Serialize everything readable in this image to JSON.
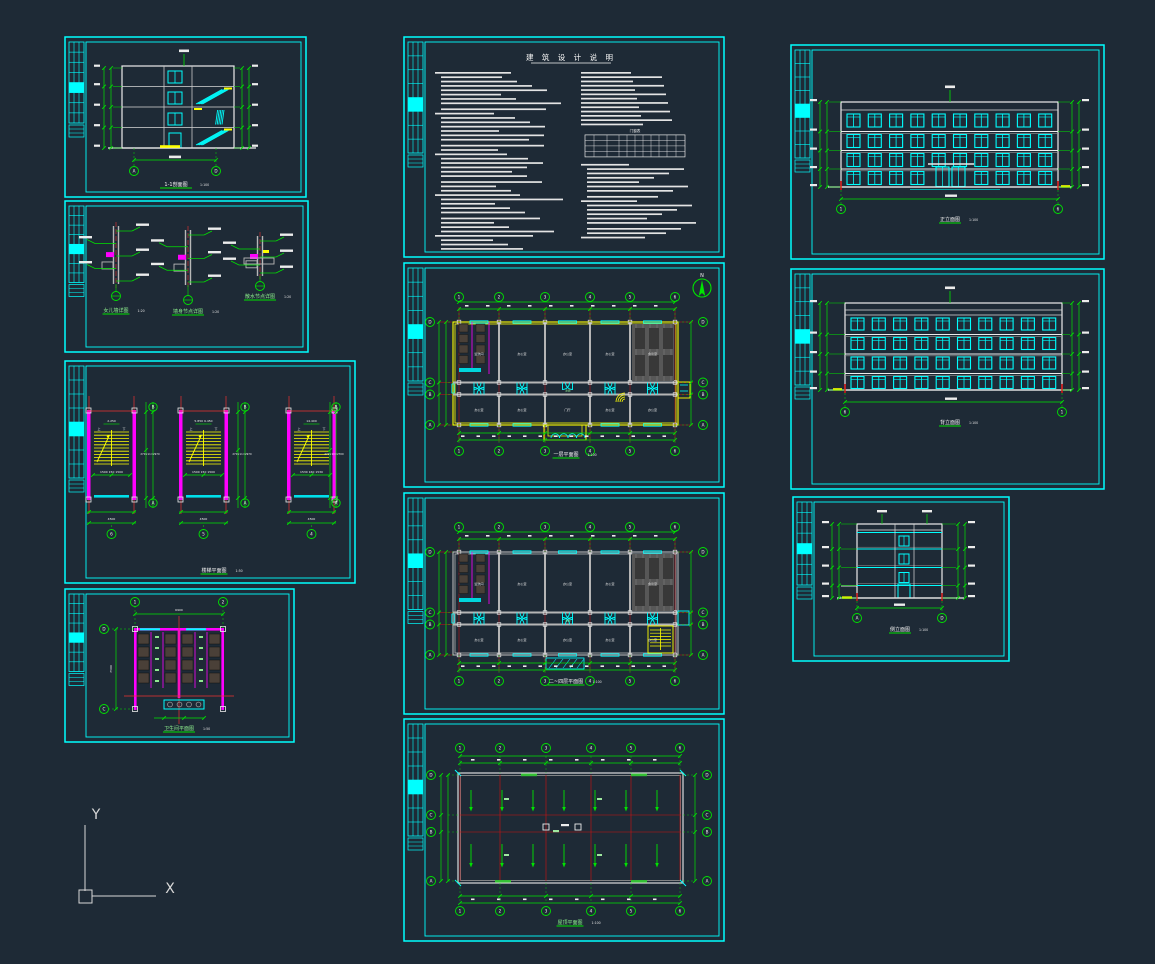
{
  "workspace": {
    "background": "#1e2a36"
  },
  "palette": {
    "cyan": "#00ffff",
    "green": "#00e400",
    "yellow": "#ffff00",
    "magenta": "#ff00ff",
    "red": "#ee1111",
    "white": "#f2f2f2",
    "gray": "#b3b3b3",
    "darkgray": "#5c5c5c",
    "stall": "#4a4038",
    "hatch_dark": "#3b3b3b"
  },
  "ucs_icon": {
    "x_label": "X",
    "y_label": "Y"
  },
  "sheets": {
    "section": {
      "caption": "1-1剖面图",
      "scale": "1:100",
      "axis_bubbles": [
        "A",
        "D"
      ]
    },
    "details": {
      "items": [
        {
          "caption": "女儿墙详图",
          "scale": "1:20"
        },
        {
          "caption": "墙身节点详图",
          "scale": "1:20"
        },
        {
          "caption": "散水节点详图",
          "scale": "1:20"
        }
      ]
    },
    "stairs": {
      "caption": "楼梯平面图",
      "scale": "1:50",
      "panels": [
        {
          "top_label": "2.250",
          "bottom_axis": "6",
          "side_axes": [
            "B",
            "A"
          ],
          "width_dim": "4500",
          "tread_dim": "1500 150 1500",
          "side_dim": "270×11=2970",
          "up_label": "上",
          "down_label": "下"
        },
        {
          "top_label": "5.850 9.450",
          "bottom_axis": "5",
          "side_axes": [
            "B",
            "A"
          ],
          "width_dim": "4500",
          "tread_dim": "1500 150 1500",
          "side_dim": "270×11=2970",
          "up_label": "上",
          "down_label": "下"
        },
        {
          "top_label": "14.400",
          "bottom_axis": "4",
          "side_axes": [
            "B",
            "A"
          ],
          "width_dim": "4500",
          "tread_dim": "1530 160 1530",
          "side_dim": "270×10=2700",
          "up_label": "上",
          "down_label": "下"
        }
      ]
    },
    "toilet": {
      "caption": "卫生间平面图",
      "scale": "1:50",
      "top_axes": [
        "1",
        "2"
      ],
      "left_axes": [
        "D",
        "C"
      ],
      "width_dim": "6900",
      "height_dim": "7500"
    },
    "notes": {
      "title": "建 筑 设 计 说 明",
      "table_title": "门窗表"
    },
    "plan1": {
      "caption": "一层平面图",
      "scale": "1:100",
      "north_label": "N",
      "top_axes": [
        "1",
        "2",
        "3",
        "4",
        "5",
        "6"
      ],
      "left_axes": [
        "D",
        "C",
        "B",
        "A"
      ],
      "rooms_top": [
        "盥洗间",
        "办公室",
        "办公室",
        "办公室",
        "会议室"
      ],
      "rooms_bottom": [
        "办公室",
        "办公室",
        "门厅",
        "办公室",
        "办公室"
      ],
      "corridor_label": "走廊"
    },
    "plan2": {
      "caption": "二~四层平面图",
      "scale": "1:100",
      "top_axes": [
        "1",
        "2",
        "3",
        "4",
        "5",
        "6"
      ],
      "left_axes": [
        "D",
        "C",
        "B",
        "A"
      ],
      "rooms_top": [
        "盥洗间",
        "办公室",
        "办公室",
        "办公室",
        "会议室"
      ],
      "rooms_bottom": [
        "办公室",
        "办公室",
        "办公室",
        "办公室",
        "办公室"
      ],
      "corridor_label": "走廊"
    },
    "roof": {
      "caption": "屋顶平面图",
      "scale": "1:100",
      "top_axes": [
        "1",
        "2",
        "3",
        "4",
        "5",
        "6"
      ],
      "left_axes": [
        "D",
        "C",
        "B",
        "A"
      ]
    },
    "elev1": {
      "caption": "正立面图",
      "scale": "1:100",
      "axis_labels": [
        "1",
        "6"
      ]
    },
    "elev2": {
      "caption": "背立面图",
      "scale": "1:100",
      "axis_labels": [
        "6",
        "1"
      ]
    },
    "elev3": {
      "caption": "侧立面图",
      "scale": "1:100",
      "axis_labels": [
        "A",
        "D"
      ]
    }
  }
}
